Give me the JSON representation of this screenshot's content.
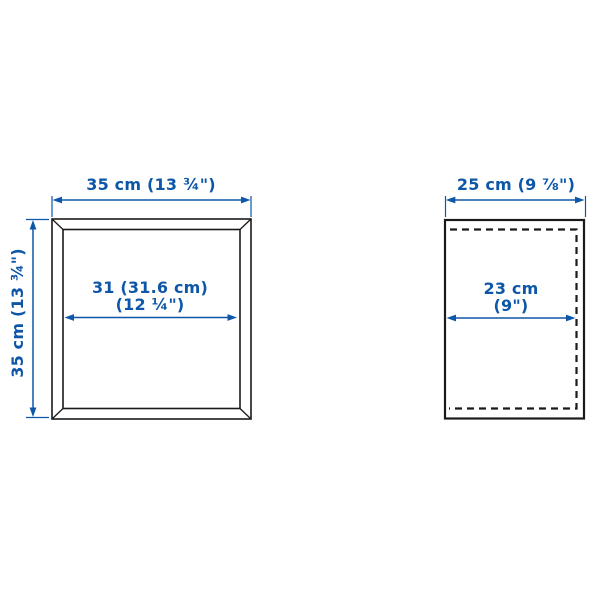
{
  "diagram": {
    "kind": "product-dimension-drawing",
    "accent_color": "#0e57a8",
    "line_color": "#1a1a1a",
    "front_view": {
      "name": "front view",
      "outer_width_label": "35 cm (13 ¾\")",
      "outer_height_label": "35 cm (13 ¾\")",
      "inner_width_label_line1": "31 (31.6 cm)",
      "inner_width_label_line2": "(12 ¼\")"
    },
    "side_view": {
      "name": "side view",
      "outer_depth_label": "25 cm (9 ⅞\")",
      "inner_depth_label_line1": "23 cm",
      "inner_depth_label_line2": "(9\")"
    }
  }
}
